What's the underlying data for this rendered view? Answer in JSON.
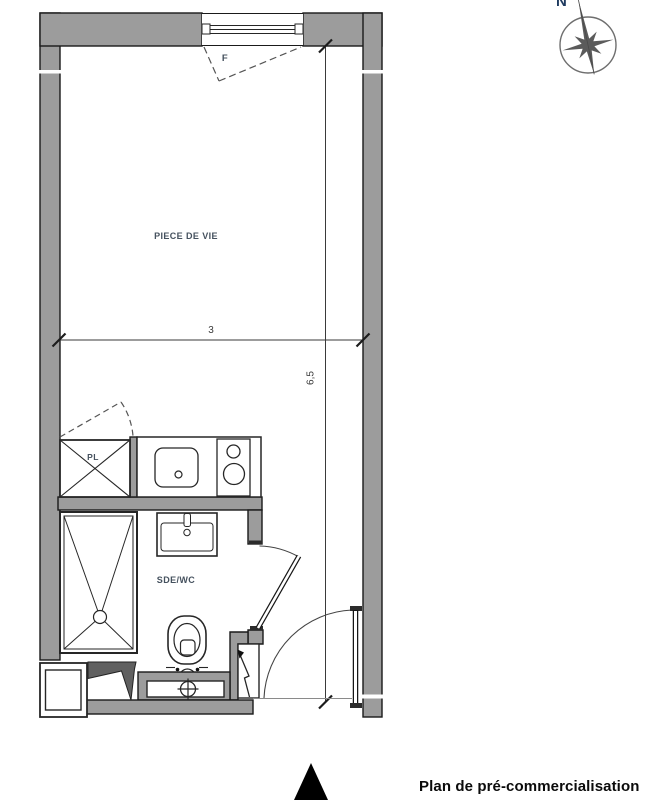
{
  "caption": {
    "text": "Plan de pré-commercialisation"
  },
  "compass": {
    "north_label": "N"
  },
  "labels": {
    "living_room": "PIECE DE VIE",
    "bathroom": "SDE/WC",
    "closet": "PL",
    "window": "F"
  },
  "dimensions": {
    "width_meters": "3",
    "height_meters": "6,5"
  },
  "colors": {
    "wall_fill": "#9c9c9c",
    "outline": "#1a1a1a",
    "room_label": "#45515e",
    "north_label": "#1e3a5f",
    "compass_star": "#5b5b5b"
  }
}
